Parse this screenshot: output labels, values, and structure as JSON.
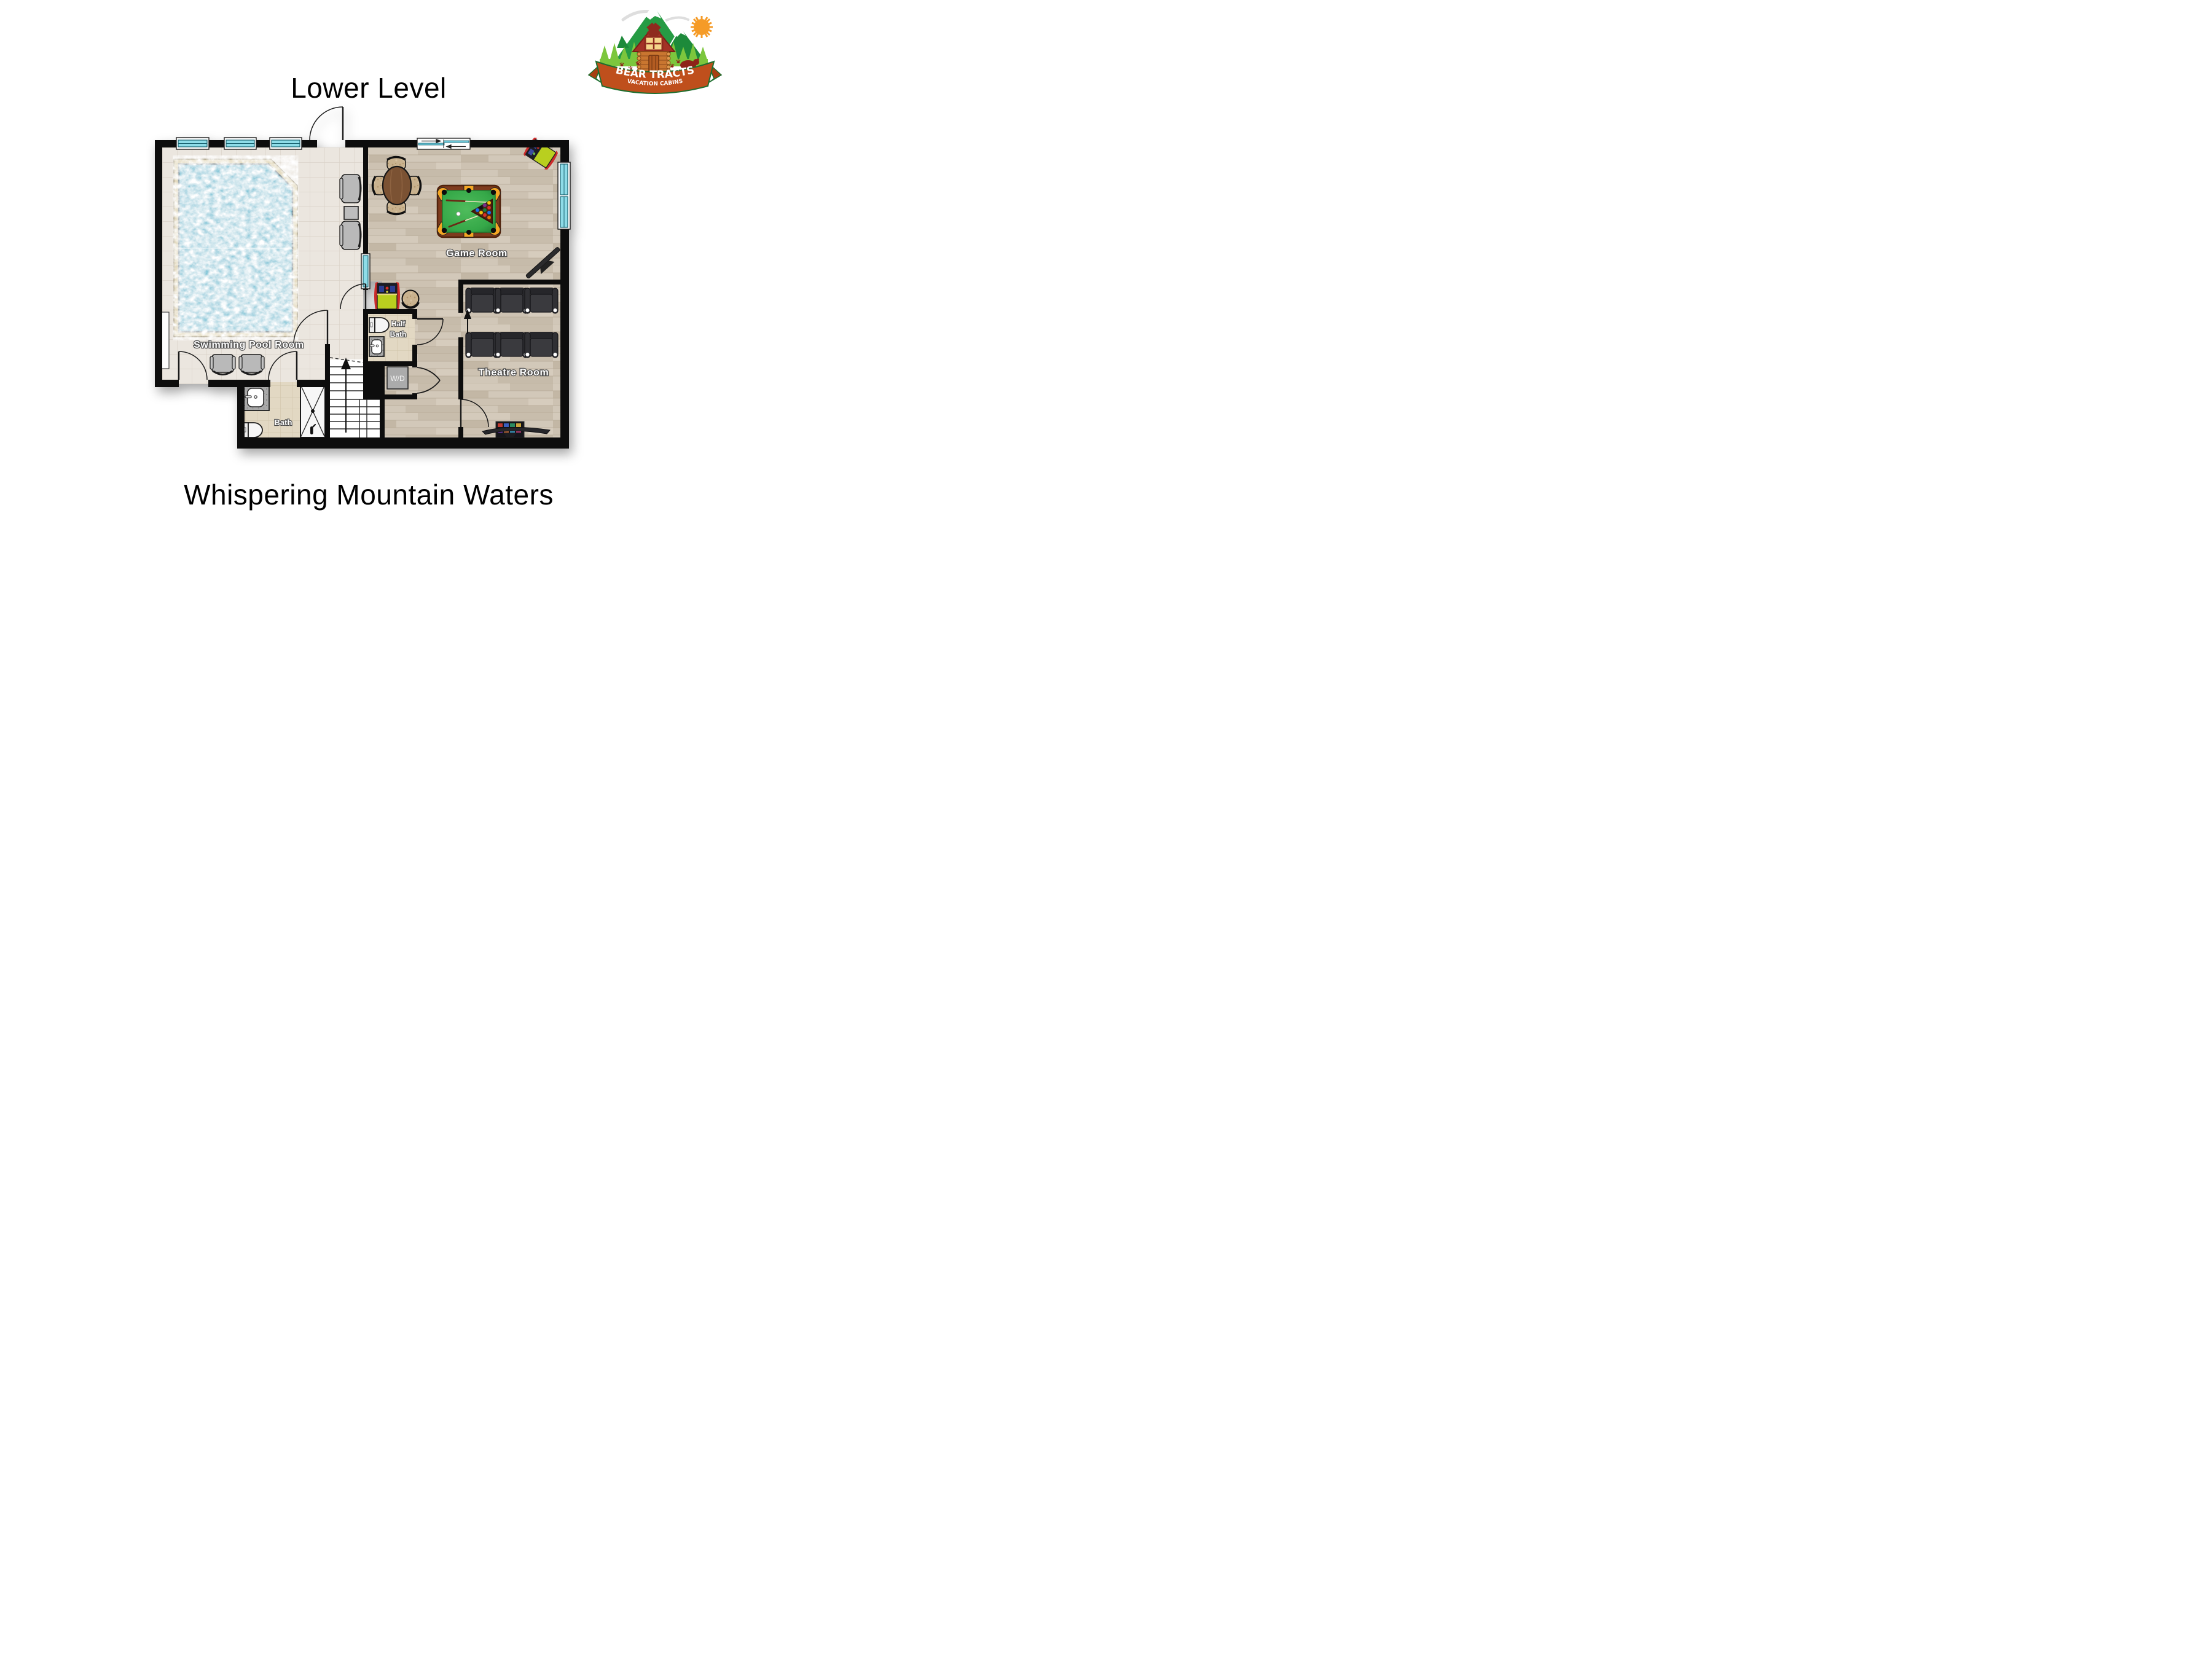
{
  "titles": {
    "top": "Lower Level",
    "bottom": "Whispering Mountain Waters"
  },
  "logo": {
    "name": "BEAR TRACTS",
    "tagline": "VACATION CABINS"
  },
  "rooms": {
    "pool": {
      "label": "Swimming Pool Room"
    },
    "game": {
      "label": "Game Room"
    },
    "theatre": {
      "label": "Theatre Room"
    },
    "half_bath": {
      "line1": "Half",
      "line2": "Bath"
    },
    "bath": {
      "label": "Bath"
    },
    "laundry": {
      "label": "W/D"
    }
  },
  "colors": {
    "wall": "#0d0d0d",
    "pool_water": "#62bdd2",
    "pool_deck": "#d9cca7",
    "tile_floor": "#ebe6df",
    "bath_tile": "#e2d8c3",
    "wood_floor": "#cfc5b6",
    "window_glass": "#8edce8",
    "pool_table_felt": "#35a848",
    "pool_table_rail": "#7e3b1d",
    "pocket_liner": "#f5a623",
    "seat_dark": "#3a3a3e",
    "chair_gray": "#b9b9b9",
    "arcade_yellow": "#b9cf1f",
    "arcade_red": "#cc2b2b",
    "logo_green_dark": "#269b44",
    "logo_green_light": "#7cc63d",
    "logo_banner": "#bf4f1c",
    "logo_cabin": "#c97630",
    "logo_roof": "#9e3125",
    "logo_sun": "#f59b27",
    "logo_bear": "#8e2318"
  }
}
